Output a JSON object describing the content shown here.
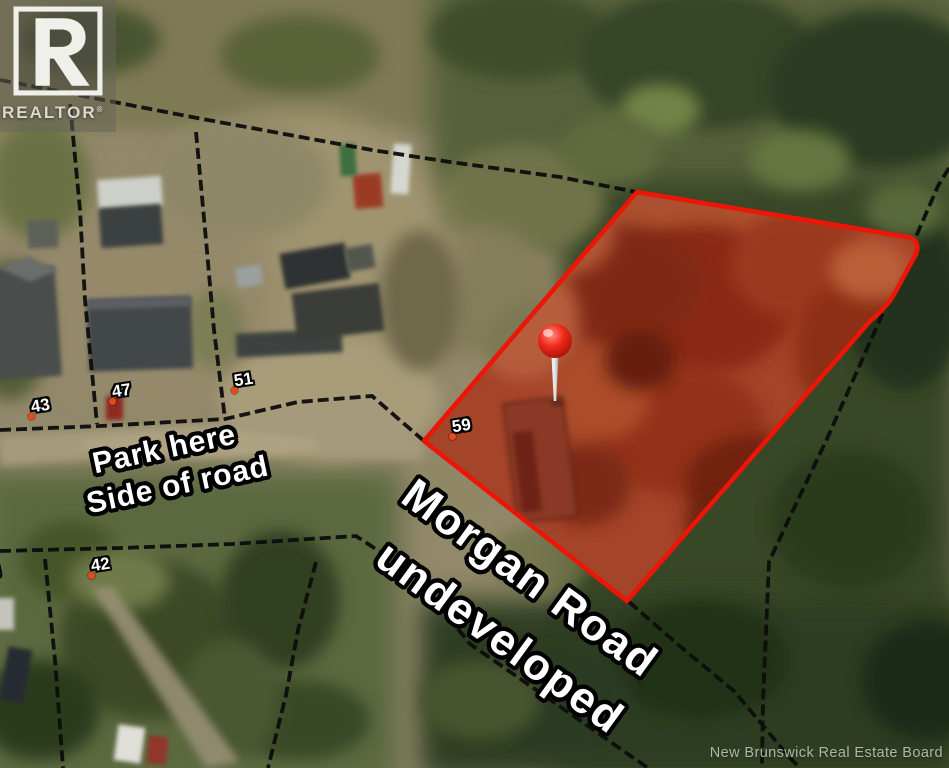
{
  "branding": {
    "realtor_logo_text": "REALTOR",
    "registered_mark": "®"
  },
  "annotations": {
    "park_line1": "Park here",
    "park_line2": "Side of road",
    "road_line1": "Morgan Road",
    "road_line2": "undeveloped"
  },
  "map_labels": {
    "houses": [
      "43",
      "47",
      "51",
      "59",
      "42"
    ],
    "edge_partial_number": "8"
  },
  "watermark": "New Brunswick Real Estate Board",
  "colors": {
    "parcel_outline": "#ec1507",
    "parcel_fill_tint": "#9a4a2e",
    "pin": "#ef2a1a",
    "marker_dot": "#e7491d",
    "boundary_line": "#0d0d0d"
  }
}
